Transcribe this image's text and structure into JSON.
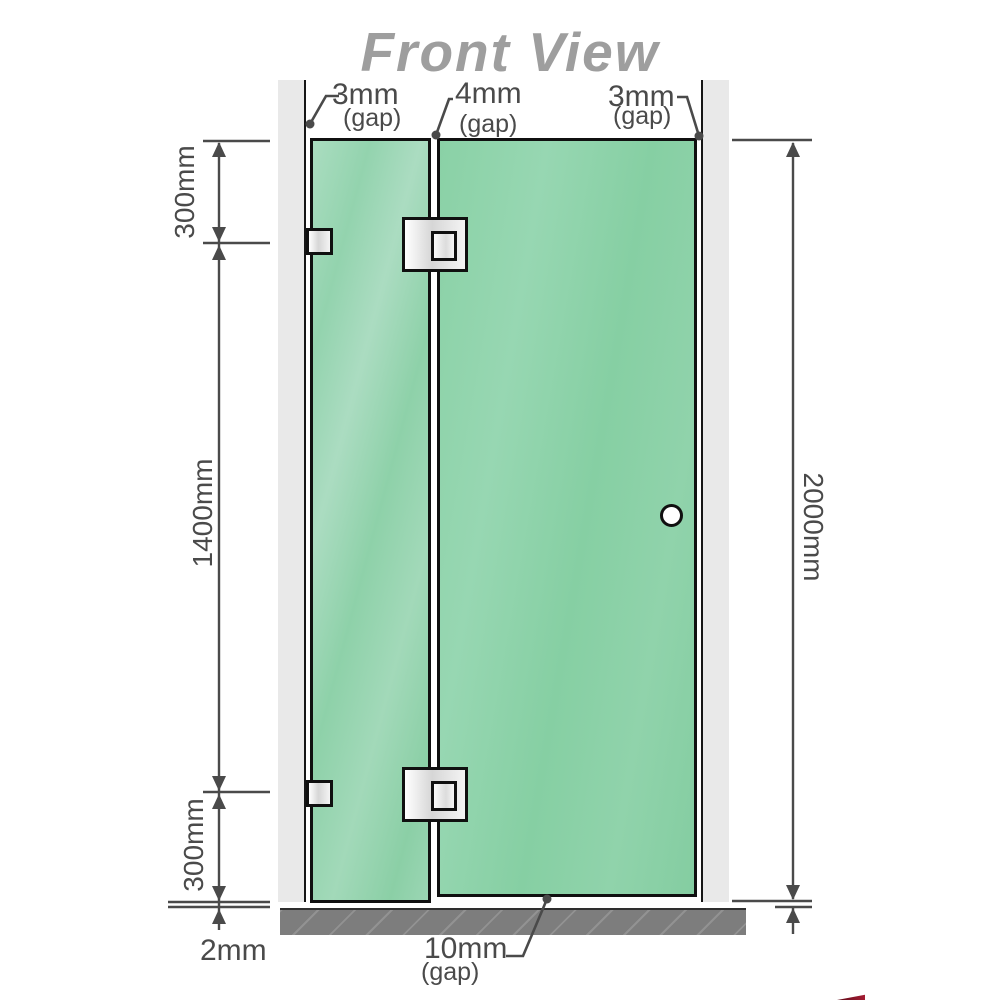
{
  "title": "Front View",
  "annotations": {
    "gap_left": {
      "value": "3mm",
      "note": "(gap)"
    },
    "gap_middle": {
      "value": "4mm",
      "note": "(gap)"
    },
    "gap_right": {
      "value": "3mm",
      "note": "(gap)"
    },
    "left_top_height": "300mm",
    "left_middle_height": "1400mm",
    "left_bottom_height": "300mm",
    "panel_floor_gap": "2mm",
    "total_height": "2000mm",
    "door_floor_gap": {
      "value": "10mm",
      "note": "(gap)"
    }
  },
  "colors": {
    "glass_green": "#8fd2ab",
    "glass_green_light": "#aaddc0",
    "wall_gray": "#e9e9e9",
    "floor_gray": "#7d7d7d",
    "dimension_gray": "#4a4a4a",
    "title_gray": "#9e9e9e",
    "fitting_metal": "#e6e6e6",
    "corner_accent_red": "#8b1528"
  }
}
